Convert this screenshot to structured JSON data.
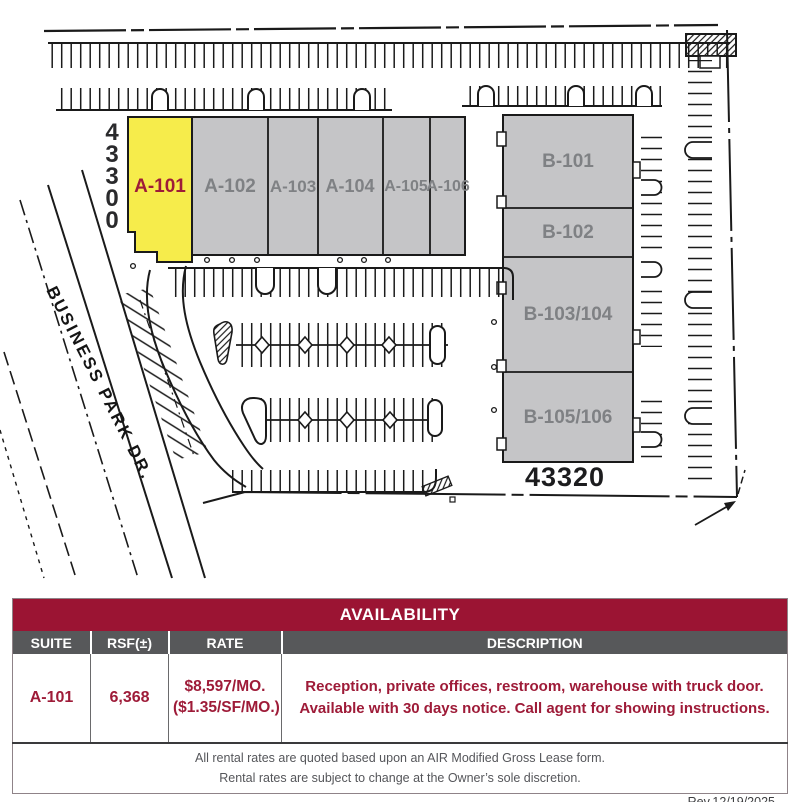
{
  "colors": {
    "highlight_yellow": "#F6EC4B",
    "building_gray": "#C5C5C7",
    "building_label_gray": "#7F8184",
    "maroon_bar": "#9B1433",
    "maroon_text": "#9E1B38",
    "header_gray": "#57585A",
    "line_black": "#1A1A1A"
  },
  "map": {
    "street_label": "BUSINESS PARK DR.",
    "address_top": "43300",
    "address_top_digits": [
      "4",
      "3",
      "3",
      "0",
      "0"
    ],
    "address_bottom": "43320",
    "building_a_suites": [
      "A-101",
      "A-102",
      "A-103",
      "A-104",
      "A-105",
      "A-106"
    ],
    "building_b_suites": [
      "B-101",
      "B-102",
      "B-103/104",
      "B-105/106"
    ],
    "highlighted_suite": "A-101"
  },
  "table": {
    "title": "AVAILABILITY",
    "columns": [
      "SUITE",
      "RSF(±)",
      "RATE",
      "DESCRIPTION"
    ],
    "rows": [
      {
        "suite": "A-101",
        "rsf": "6,368",
        "rate_line1": "$8,597/MO.",
        "rate_line2": "($1.35/SF/MO.)",
        "description_line1": "Reception, private offices, restroom, warehouse with truck door.",
        "description_line2": "Available with 30 days notice. Call agent for showing instructions."
      }
    ],
    "footnote_line1": "All rental rates are quoted based upon an AIR Modified Gross Lease form.",
    "footnote_line2": "Rental rates are subject to change at the Owner’s sole discretion.",
    "revision": "Rev.12/19/2025"
  }
}
